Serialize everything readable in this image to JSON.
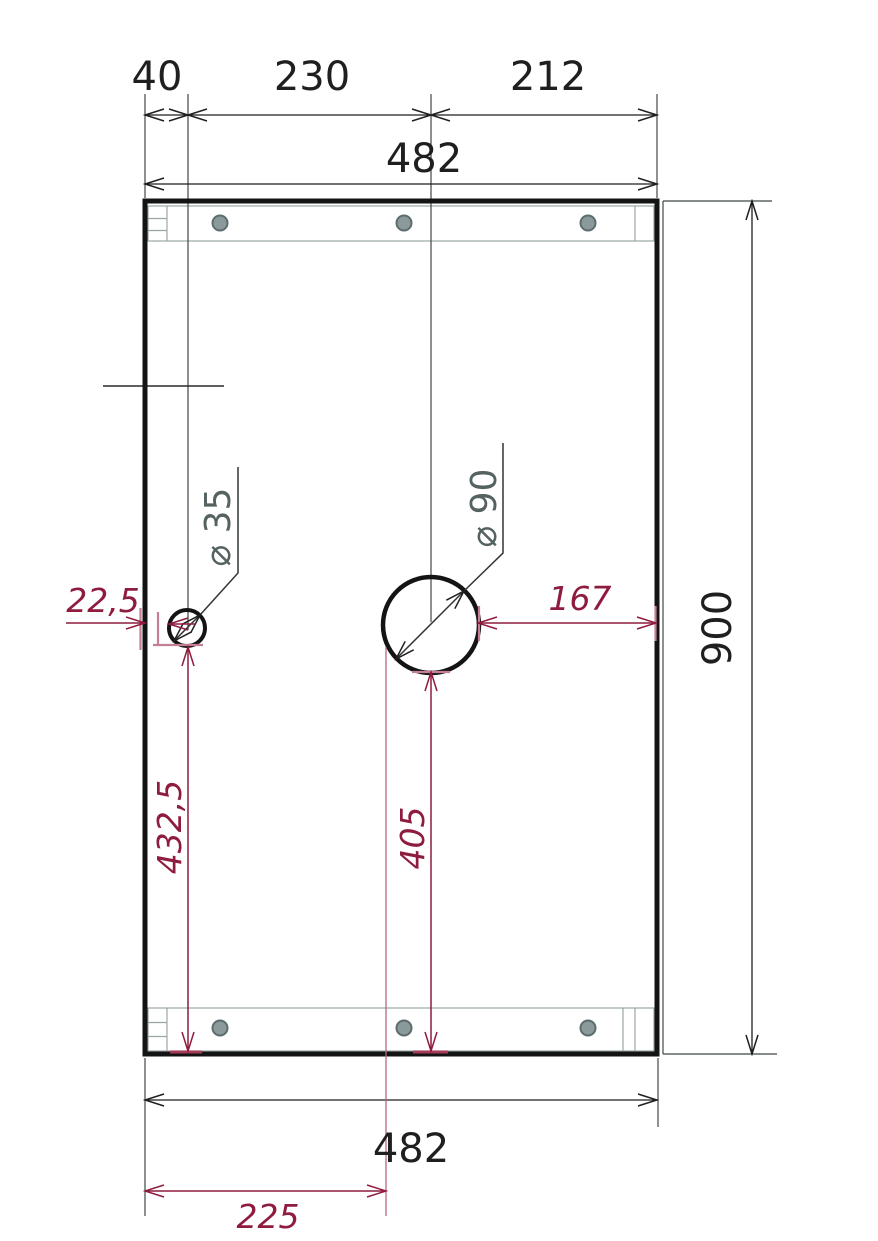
{
  "drawing": {
    "dims": {
      "seg40": "40",
      "seg230": "230",
      "seg212": "212",
      "total_top": "482",
      "height": "900",
      "total_bottom": "482",
      "offset225": "225",
      "edge_to_small_hole": "22,5",
      "large_hole_to_edge": "167",
      "small_hole_from_bottom": "432,5",
      "large_hole_from_bottom": "405",
      "small_hole_dia": "⌀ 35",
      "large_hole_dia": "⌀ 90"
    },
    "colors": {
      "dim_black": "#1f1f1f",
      "dim_red": "#8f1c3e",
      "ext_red": "#c57f93",
      "label_gray": "#566161",
      "rail_gray": "#9aa6a6",
      "screw_gray": "#8a9a9a",
      "outline": "#141414"
    }
  }
}
